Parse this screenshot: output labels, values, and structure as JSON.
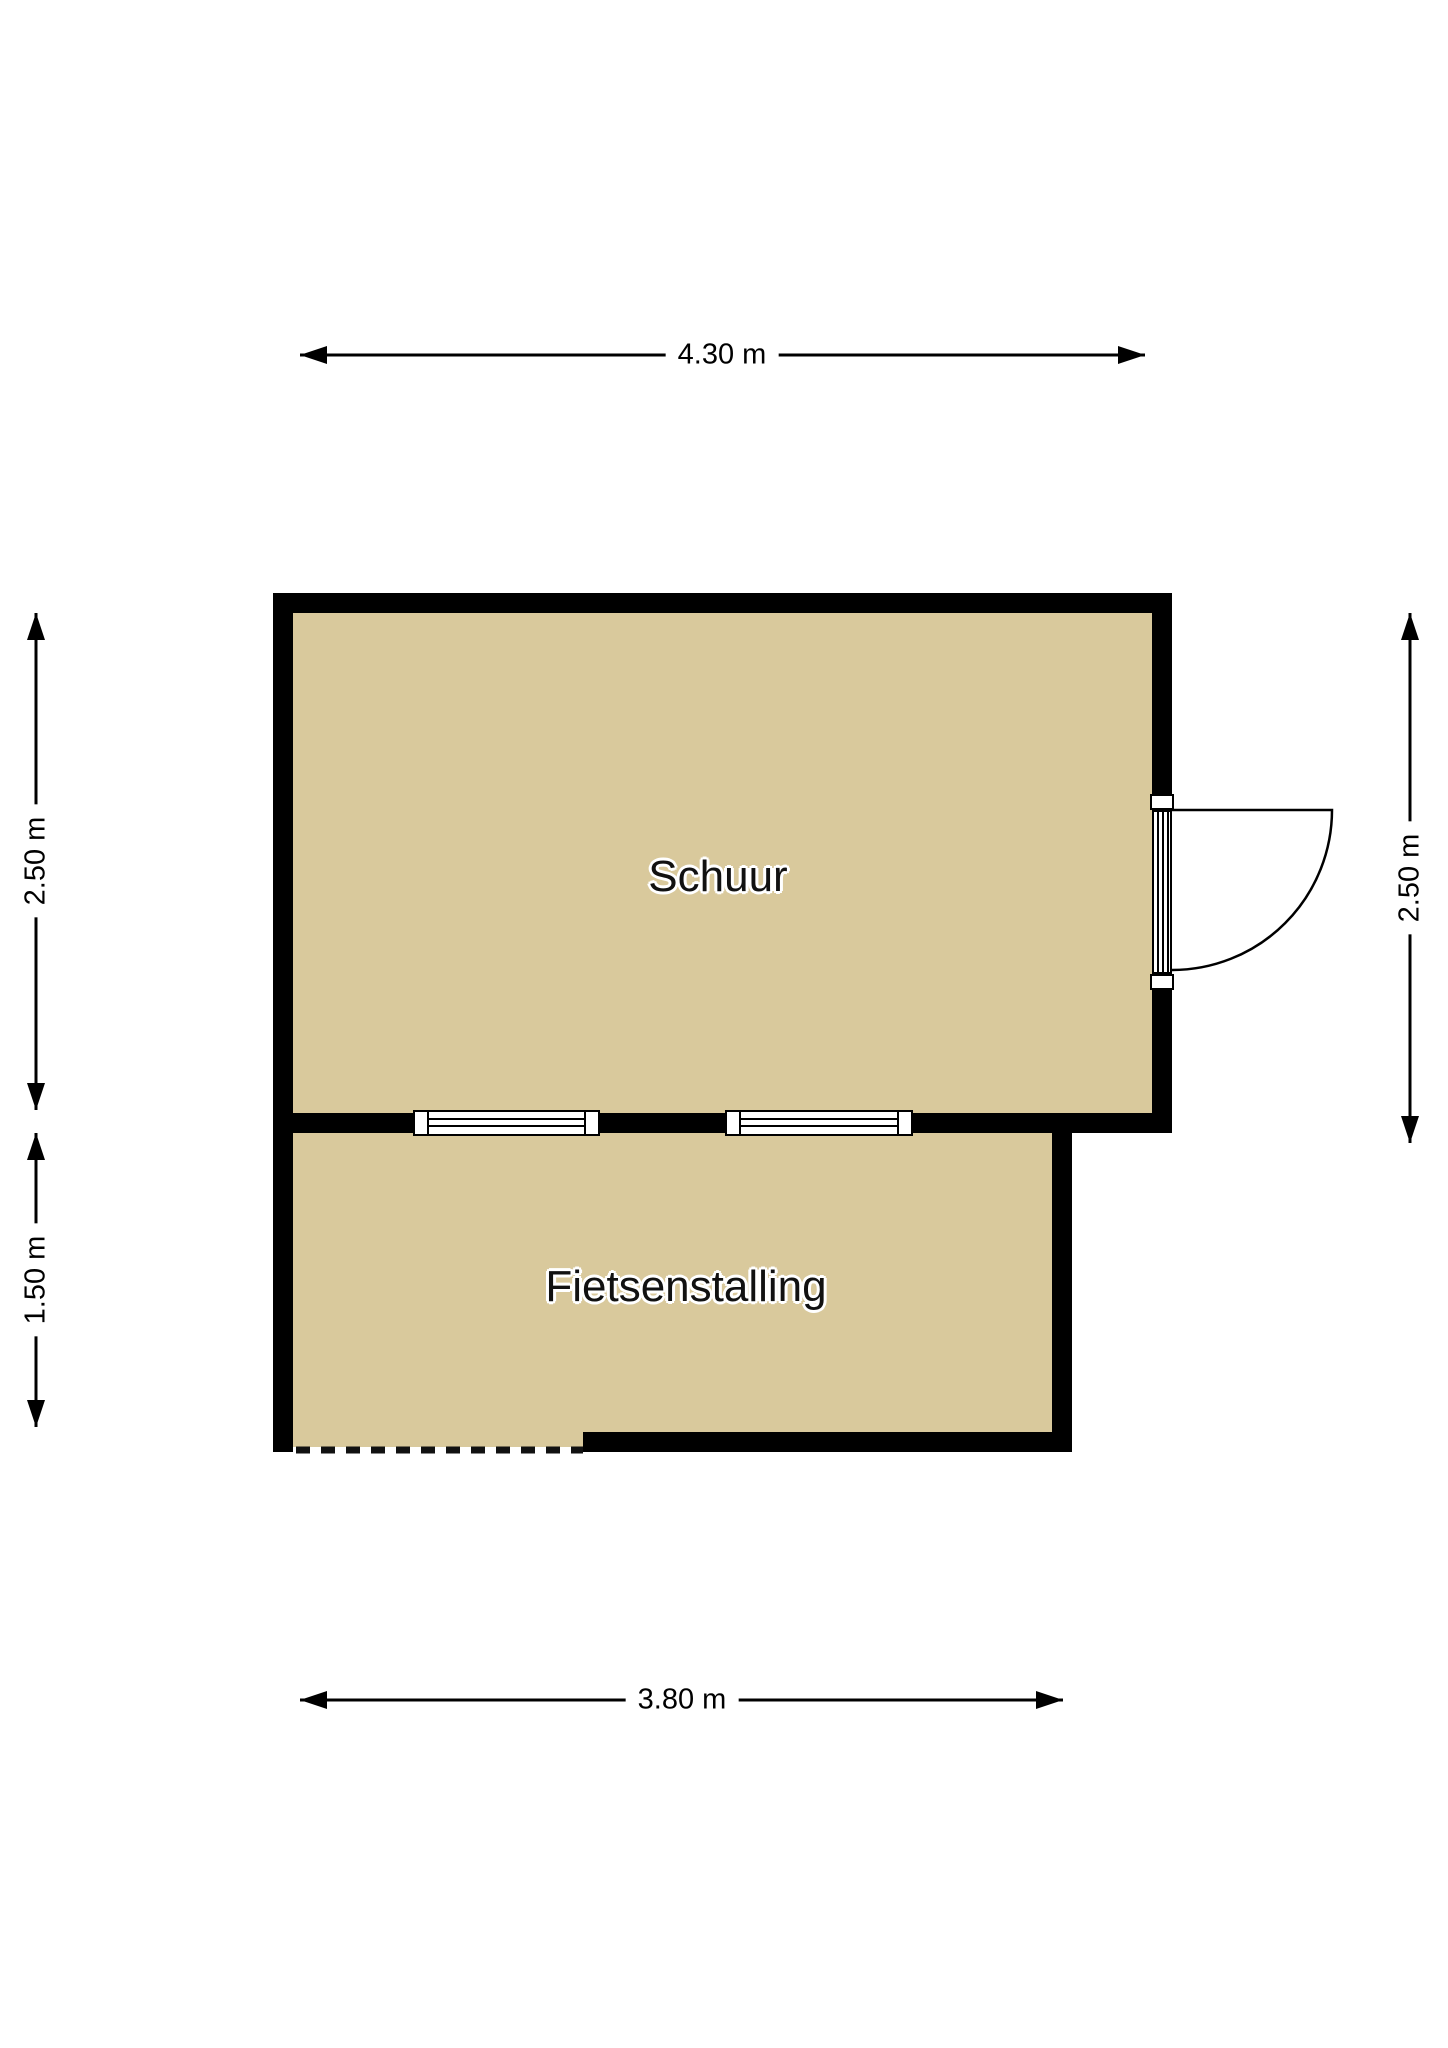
{
  "plan": {
    "rooms": [
      {
        "name": "Schuur",
        "width_label": "4.30 m",
        "depth_label": "2.50 m"
      },
      {
        "name": "Fietsenstalling",
        "width_label": "3.80 m",
        "depth_label": "1.50 m"
      }
    ],
    "dimensions": {
      "top": "4.30 m",
      "left_upper": "2.50 m",
      "left_lower": "1.50 m",
      "right": "2.50 m",
      "bottom": "3.80 m"
    },
    "features": {
      "door": "single swing door on right wall of Schuur, opening outward",
      "windows": 2,
      "open_side": "dashed open edge at bottom-left of Fietsenstalling"
    },
    "colors": {
      "floor": "#d9c99c",
      "wall": "#000000",
      "background": "#ffffff",
      "text": "#111111"
    }
  }
}
